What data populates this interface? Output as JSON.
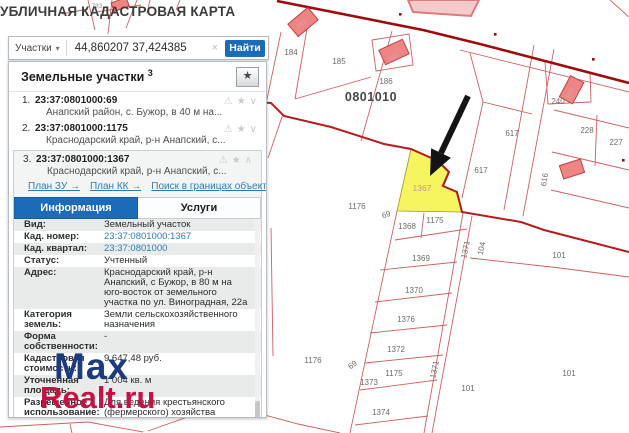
{
  "title": "УБЛИЧНАЯ КАДАСТРОВАЯ КАРТА",
  "search": {
    "category": "Участки",
    "dropdown_arrow": "▾",
    "query": "44,860207 37,424385",
    "clear": "×",
    "button": "Найти"
  },
  "panel": {
    "header": {
      "title": "Земельные участки",
      "count": "3",
      "star": "★"
    },
    "items": [
      {
        "num": "1.",
        "cadastral": "23:37:0801000:69",
        "desc": "Анапский район, с. Бужор, в 40 м на...",
        "icons": {
          "warn": "⚠",
          "star": "★",
          "chevron": "∨"
        }
      },
      {
        "num": "2.",
        "cadastral": "23:37:0801000:1175",
        "desc": "Краснодарский край, р-н Анапский, с...",
        "icons": {
          "warn": "⚠",
          "star": "★",
          "chevron": "∨"
        }
      },
      {
        "num": "3.",
        "cadastral": "23:37:0801000:1367",
        "desc": "Краснодарский край, р-н Анапский, с...",
        "icons": {
          "warn": "⚠",
          "star": "★",
          "chevron": "∧"
        },
        "links": [
          "План ЗУ →",
          "План КК →",
          "Поиск в границах объекта →"
        ]
      }
    ],
    "tabs": [
      {
        "label": "Информация",
        "active": true
      },
      {
        "label": "Услуги",
        "active": false
      }
    ],
    "info_rows": [
      {
        "label": "Вид:",
        "value": "Земельный участок",
        "link": false
      },
      {
        "label": "Кад. номер:",
        "value": "23:37:0801000:1367",
        "link": true
      },
      {
        "label": "Кад. квартал:",
        "value": "23:37:0801000",
        "link": true
      },
      {
        "label": "Статус:",
        "value": "Учтенный",
        "link": false
      },
      {
        "label": "Адрес:",
        "value": "Краснодарский край, р-н Анапский, с Бужор, в 80 м на юго-восток от земельного участка по ул. Виноградная, 22а",
        "link": false
      },
      {
        "label": "Категория земель:",
        "value": "Земли сельскохозяйственного назначения",
        "link": false
      },
      {
        "label": "Форма собственности:",
        "value": "-",
        "link": false
      },
      {
        "label": "Кадастровая стоимость:",
        "value": "9 647,48 руб.",
        "link": false
      },
      {
        "label": "Уточненная площадь:",
        "value": "1 004 кв. м",
        "link": false
      },
      {
        "label": "Разрешенное использование:",
        "value": "Для ведения крестьянского (фермерского) хозяйства",
        "link": false
      },
      {
        "label": "по документу:",
        "value": "Крестьянское (фермерское) хозяйство",
        "link": false
      }
    ]
  },
  "watermark": {
    "line1": "Max",
    "line2": "Realt.ru"
  },
  "map": {
    "highlighted_parcel": "1367",
    "quarter_label": "0801010",
    "labels": [
      {
        "t": "783",
        "x": 97,
        "y": 8,
        "c": "tiny"
      },
      {
        "t": "787",
        "x": 303,
        "y": 26,
        "c": "pale",
        "r": -40
      },
      {
        "t": "184",
        "x": 291,
        "y": 55
      },
      {
        "t": "185",
        "x": 339,
        "y": 64
      },
      {
        "t": "502",
        "x": 394,
        "y": 59,
        "c": "pale",
        "r": -25
      },
      {
        "t": "186",
        "x": 386,
        "y": 84
      },
      {
        "t": "0801010",
        "x": 371,
        "y": 101,
        "c": "big"
      },
      {
        "t": "605",
        "x": 572,
        "y": 94,
        "c": "pale",
        "r": -65
      },
      {
        "t": "240",
        "x": 558,
        "y": 104
      },
      {
        "t": "617",
        "x": 512,
        "y": 136
      },
      {
        "t": "228",
        "x": 587,
        "y": 133
      },
      {
        "t": "227",
        "x": 616,
        "y": 145
      },
      {
        "t": "617",
        "x": 481,
        "y": 173
      },
      {
        "t": "616",
        "x": 547,
        "y": 180,
        "r": -80
      },
      {
        "t": "1367",
        "x": 422,
        "y": 191,
        "c": "hl"
      },
      {
        "t": "1176",
        "x": 357,
        "y": 209
      },
      {
        "t": "69",
        "x": 387,
        "y": 217,
        "r": -20
      },
      {
        "t": "1175",
        "x": 435,
        "y": 223
      },
      {
        "t": "1368",
        "x": 407,
        "y": 229
      },
      {
        "t": "1371",
        "x": 468,
        "y": 250,
        "r": -78
      },
      {
        "t": "104",
        "x": 484,
        "y": 249,
        "r": -78
      },
      {
        "t": "101",
        "x": 559,
        "y": 258
      },
      {
        "t": "1369",
        "x": 421,
        "y": 261
      },
      {
        "t": "1370",
        "x": 414,
        "y": 293
      },
      {
        "t": "1376",
        "x": 406,
        "y": 322
      },
      {
        "t": "1372",
        "x": 396,
        "y": 352
      },
      {
        "t": "1176",
        "x": 313,
        "y": 363
      },
      {
        "t": "69",
        "x": 354,
        "y": 367,
        "r": -35
      },
      {
        "t": "1371",
        "x": 437,
        "y": 370,
        "r": -78
      },
      {
        "t": "1175",
        "x": 394,
        "y": 376
      },
      {
        "t": "101",
        "x": 569,
        "y": 376
      },
      {
        "t": "1373",
        "x": 369,
        "y": 385
      },
      {
        "t": "101",
        "x": 468,
        "y": 391
      },
      {
        "t": "1374",
        "x": 381,
        "y": 415
      }
    ]
  },
  "colors": {
    "accent": "#1c6bb8",
    "map_line": "#cf5f5f",
    "road": "#9e0b0e",
    "boundary": "#b51d1d",
    "parcel_fill": "#f7f55f",
    "building_fill": "#ee8585",
    "watermark_blue": "#1d3a7c",
    "watermark_red": "#c51244"
  }
}
